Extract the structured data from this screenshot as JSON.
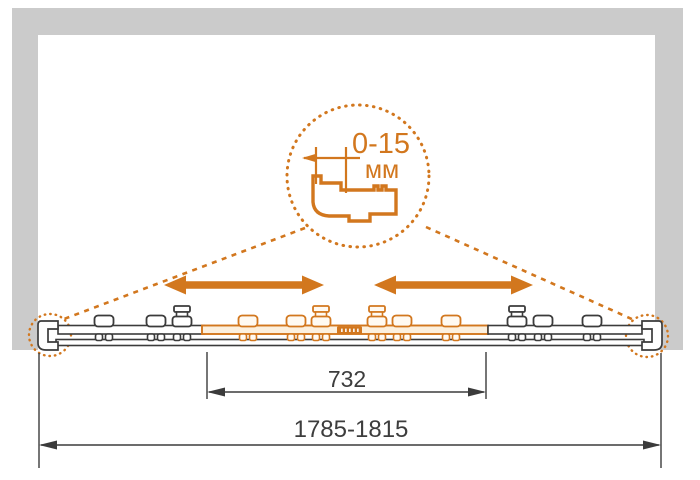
{
  "colors": {
    "accent_orange": "#d2771e",
    "accent_orange_light": "#fcf0de",
    "rail_dark": "#3b3b3b",
    "wall_gray": "#cbcbcb",
    "dim_color": "#3d3d3d",
    "background": "#ffffff"
  },
  "callout": {
    "range_label": "0-15",
    "unit_label": "мм"
  },
  "dimensions": {
    "door_panel_width": "732",
    "overall_width_range": "1785-1815"
  },
  "icons": {
    "slide_arrow_left": "double-headed-horizontal-arrow",
    "slide_arrow_right": "double-headed-horizontal-arrow",
    "callout_circle": "dotted-magnifier-circle"
  }
}
